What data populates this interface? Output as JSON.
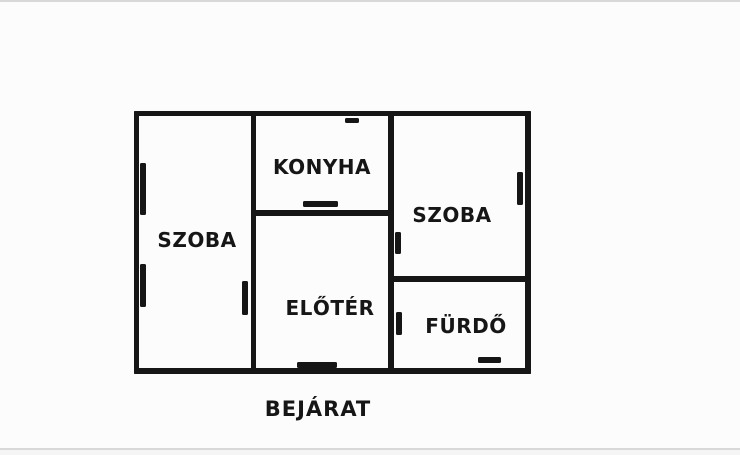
{
  "plan": {
    "rooms": [
      {
        "id": "szoba-left",
        "label": "SZOBA"
      },
      {
        "id": "konyha",
        "label": "KONYHA"
      },
      {
        "id": "szoba-right",
        "label": "SZOBA"
      },
      {
        "id": "eloter",
        "label": "ELŐTÉR"
      },
      {
        "id": "furdo",
        "label": "FÜRDŐ"
      }
    ],
    "entrance_label": "BEJÁRAT",
    "colors": {
      "wall": "#161616",
      "background": "#fcfcfc",
      "text": "#161616",
      "frame_line": "#d8d8d8"
    }
  }
}
